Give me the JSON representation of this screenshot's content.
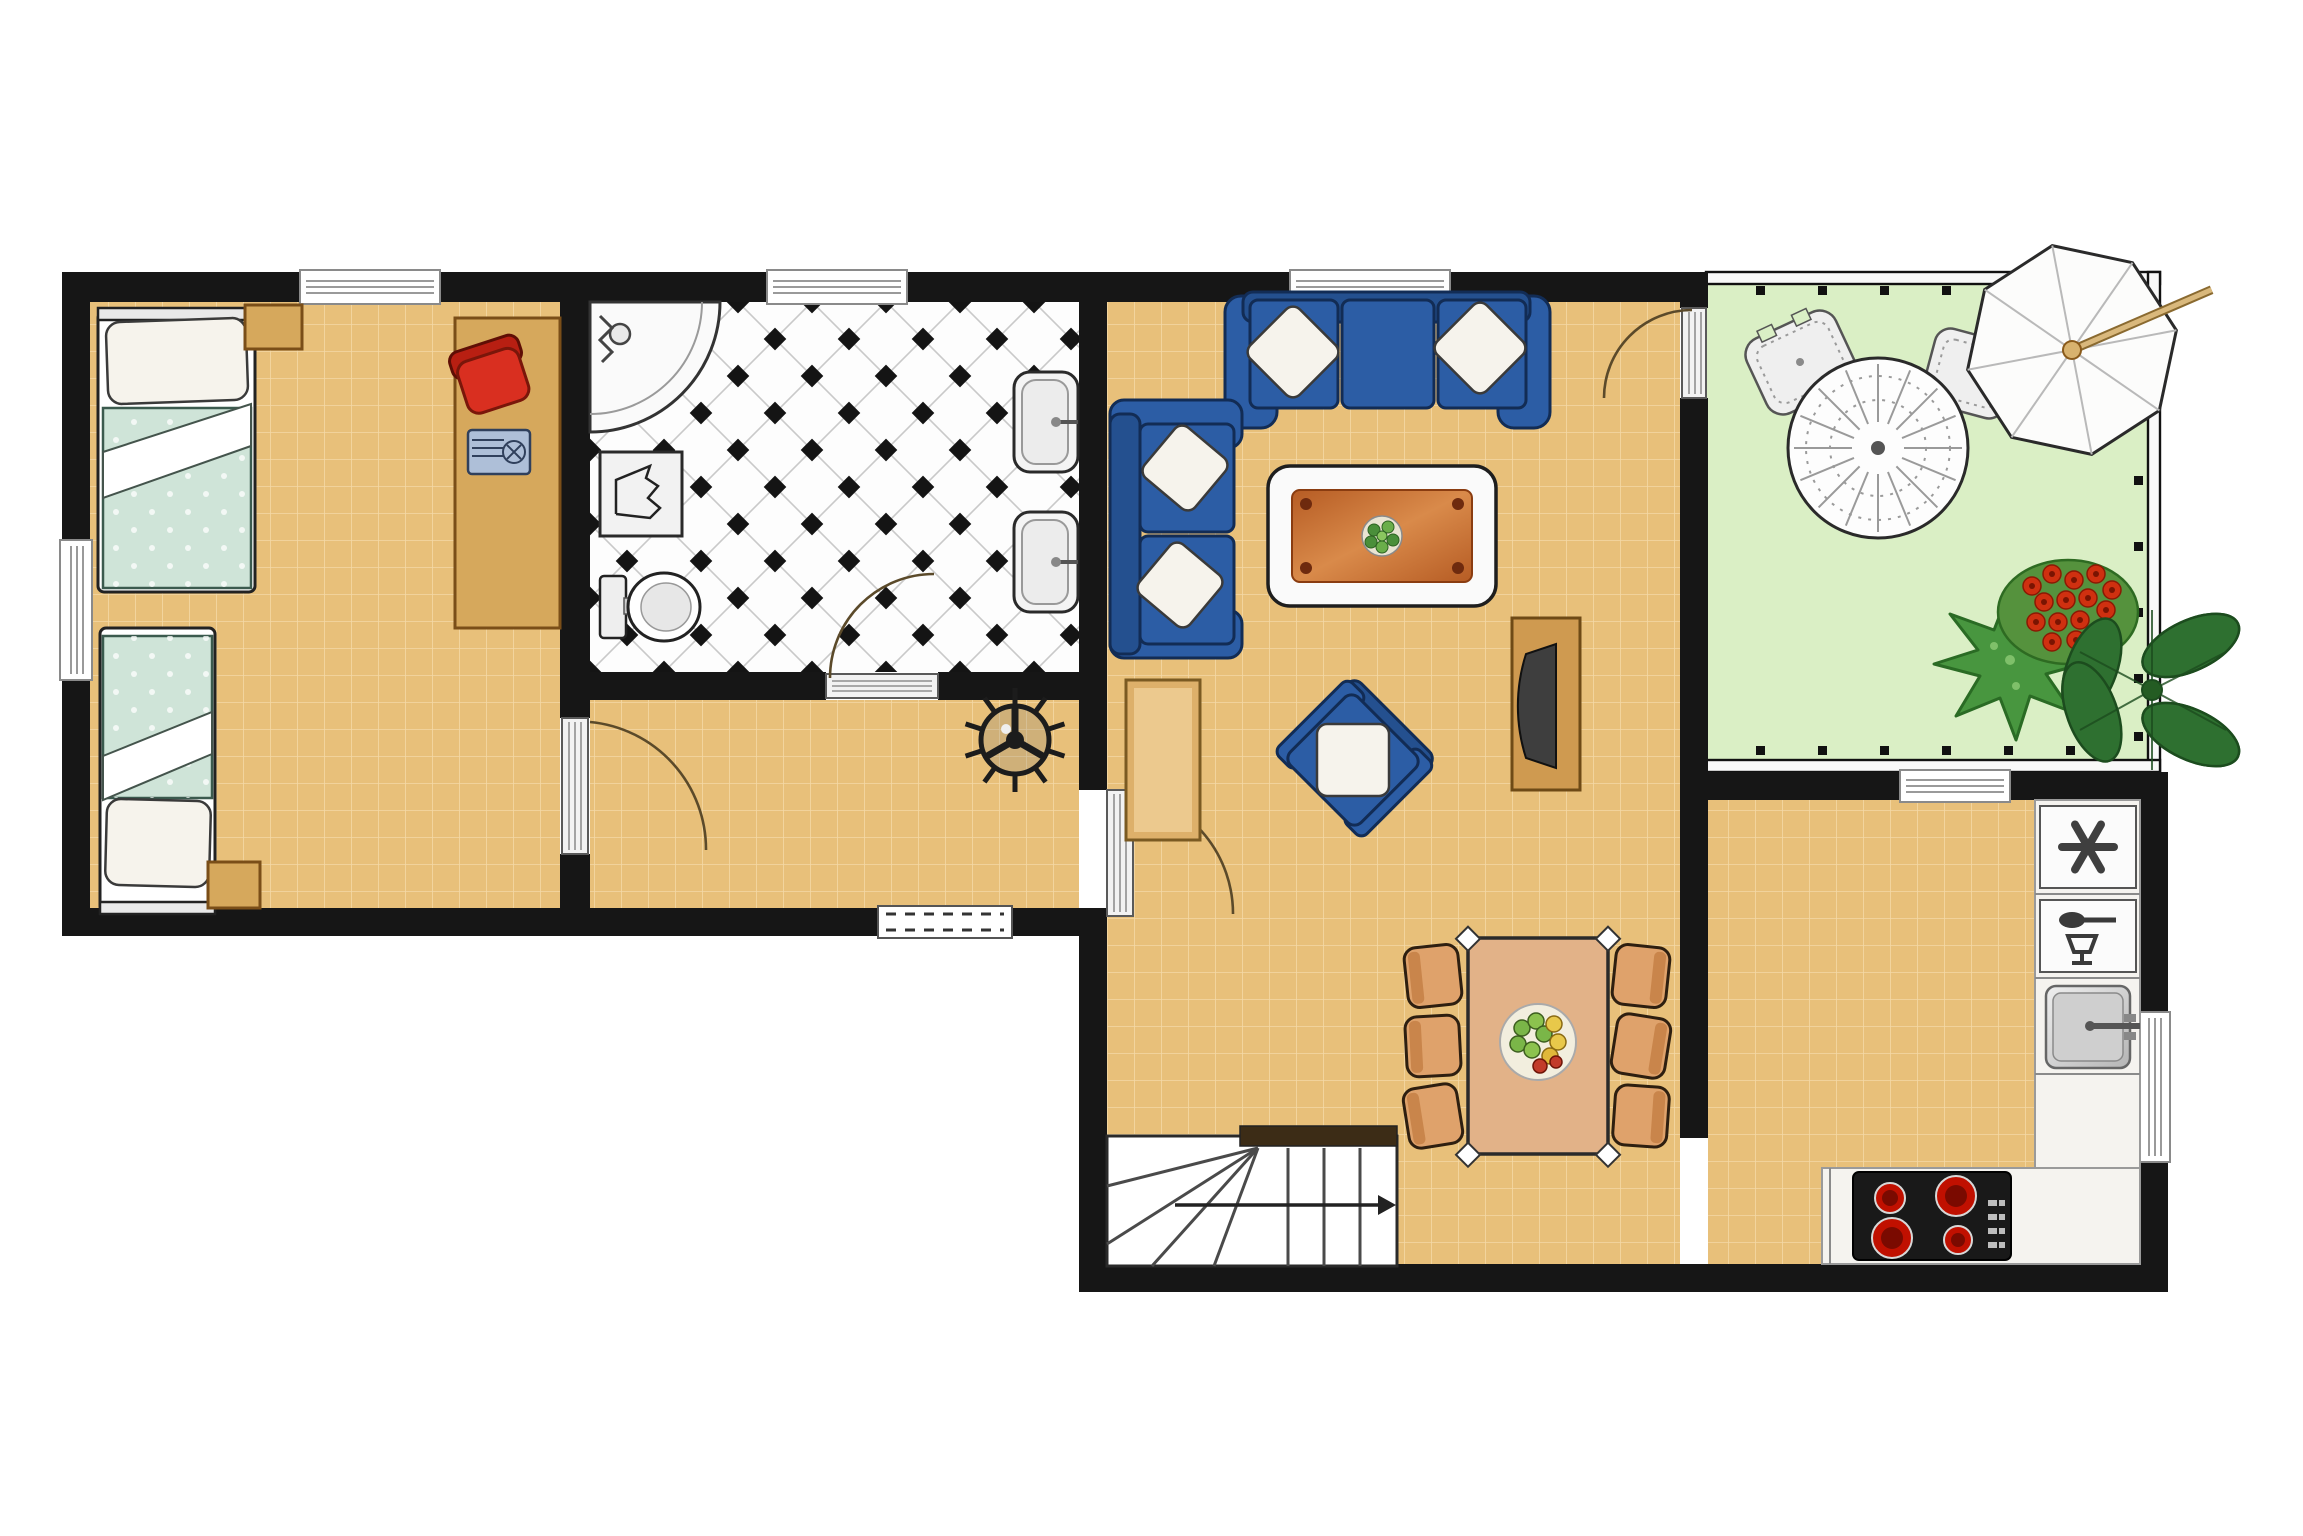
{
  "document": {
    "kind": "architectural floor plan",
    "description": "Single-storey apartment plan with bedroom, bathroom, hallway, open living-dining room with stairs, kitchen and a garden patio",
    "visible_text": "none"
  },
  "palette": {
    "wall": "#161616",
    "floor-tan": "#e8c07a",
    "grid-line": "#f4d9a6",
    "patio-green": "#daefc5",
    "sofa-blue": "#2c5da5",
    "sofa-outline": "#122c55",
    "pillow-white": "#f6f3ec",
    "wood-light": "#d6a85c",
    "wood-dark": "#7a4e18",
    "bed-green": "#cfe4d8",
    "red-chair": "#d92f20",
    "table-orange": "#c76a2e",
    "counter-white": "#f5f3ef",
    "burner-red": "#c01000",
    "dining-chair": "#dfa26b",
    "plant-green": "#3b8539",
    "flower-red": "#cf3010",
    "door-arc": "#5b4a2a",
    "bath-tile-diamond": "#141414"
  },
  "rooms": [
    {
      "id": "bedroom",
      "label": "bedroom",
      "floor": "tan tile grid",
      "furniture": [
        "single-bed-top",
        "nightstand-top",
        "single-bed-bottom",
        "nightstand-bottom",
        "desk",
        "red-desk-chair",
        "laptop"
      ]
    },
    {
      "id": "bathroom",
      "label": "bathroom",
      "floor": "white diagonal tile with black diamonds",
      "furniture": [
        "corner-shower",
        "laundry-box",
        "toilet",
        "wash-basin-upper",
        "wash-basin-lower"
      ]
    },
    {
      "id": "hallway",
      "label": "hallway",
      "floor": "tan tile grid",
      "furniture": [
        "ceiling-fan-symbol",
        "entrance-mat"
      ]
    },
    {
      "id": "living-dining",
      "label": "living and dining room",
      "floor": "tan tile grid",
      "furniture": [
        "three-seat-sofa",
        "two-seat-sofa",
        "coffee-table",
        "armchair",
        "side-table",
        "tv-bench",
        "dining-table",
        "dining-chairs-x6",
        "staircase"
      ]
    },
    {
      "id": "kitchen",
      "label": "kitchen",
      "floor": "tan tile grid",
      "furniture": [
        "freezer",
        "dishwasher",
        "kitchen-sink",
        "l-shaped-counter",
        "cooktop-4-burners"
      ]
    },
    {
      "id": "patio",
      "label": "patio / garden",
      "floor": "light green lawn",
      "furniture": [
        "round-lace-table",
        "patio-chair-left",
        "patio-chair-right",
        "parasol",
        "spiky-plant",
        "red-flower-shrub",
        "broadleaf-plant"
      ]
    }
  ],
  "openings": {
    "windows": [
      "bedroom-top-window",
      "bathroom-top-window",
      "living-top-window",
      "bedroom-left-window",
      "kitchen-top-window",
      "kitchen-right-window"
    ],
    "doors": [
      "bedroom-to-hallway-door",
      "bathroom-door",
      "hallway-to-living-door",
      "living-to-patio-door"
    ],
    "entrance": [
      "front-entrance-mat"
    ]
  }
}
